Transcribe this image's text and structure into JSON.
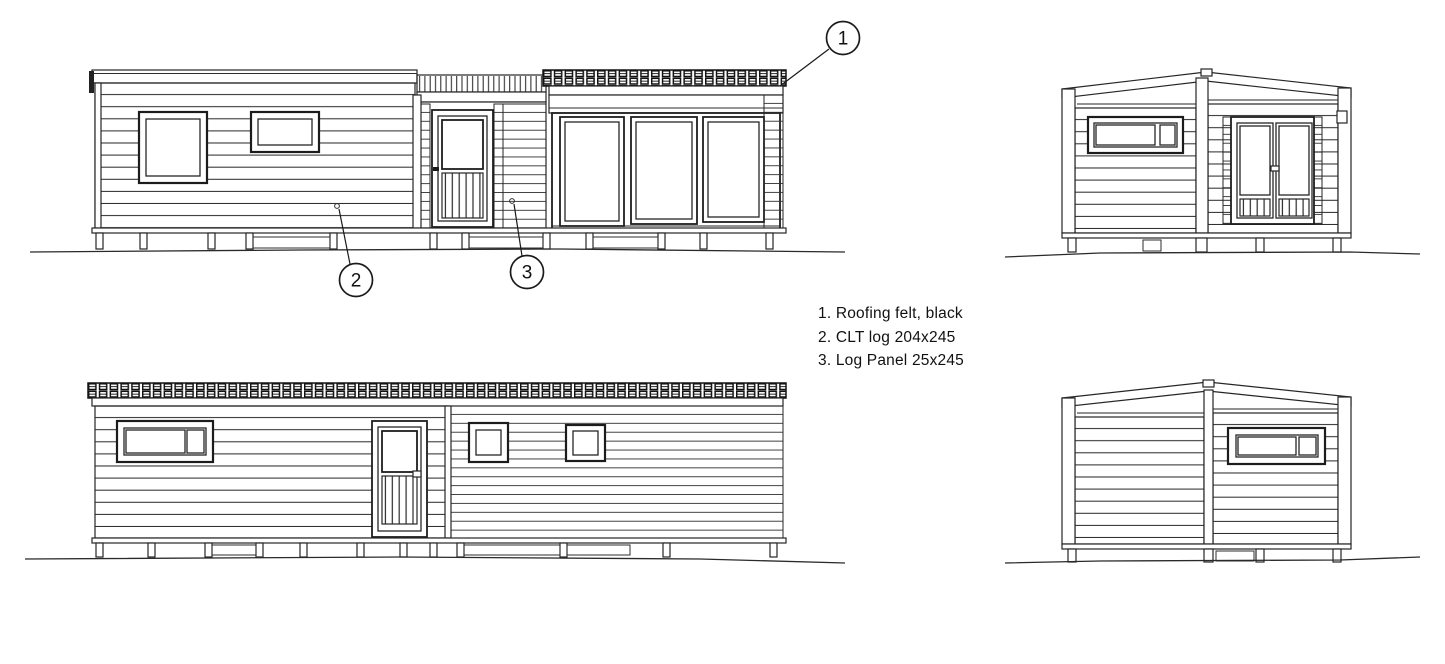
{
  "sheet": {
    "background": "#ffffff",
    "ink_color": "#222222"
  },
  "legend": {
    "items": [
      "1. Roofing felt, black",
      "2. CLT log 204x245",
      "3. Log Panel 25x245"
    ]
  },
  "callouts": {
    "roofing_felt": "1",
    "clt_log": "2",
    "log_panel": "3"
  }
}
